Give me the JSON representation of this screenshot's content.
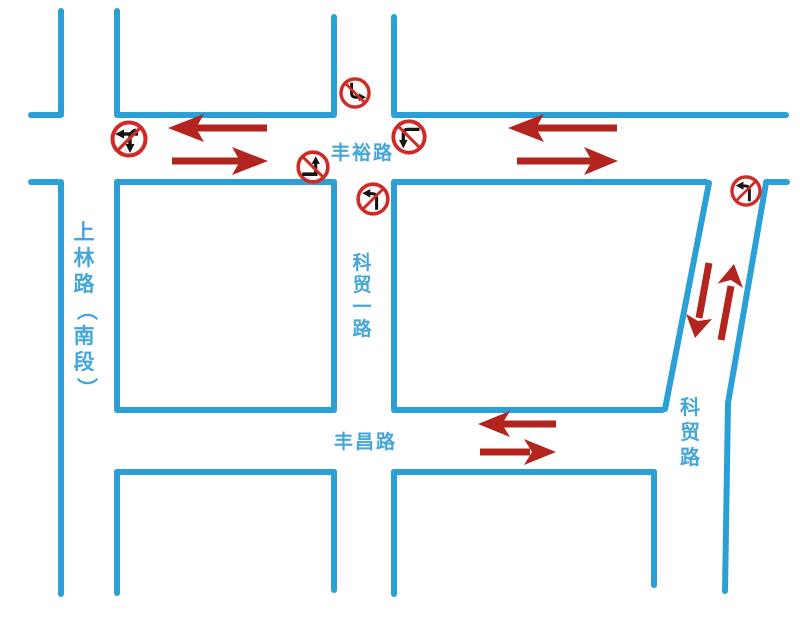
{
  "colors": {
    "road_blue": "#2aa0d6",
    "label_blue": "#45a6da",
    "flow_arrow_red": "#b4241e",
    "sign_red": "#ce2a26",
    "sign_arrow_black": "#141414"
  },
  "roads": {
    "fengyu": {
      "label": "丰裕路"
    },
    "fengchang": {
      "label": "丰昌路"
    },
    "shanglin": {
      "label": "上林路（南段）",
      "chars": [
        "上",
        "林",
        "路",
        "（",
        "南",
        "段",
        "）"
      ]
    },
    "kemao_first": {
      "label": "科贸一路",
      "chars": [
        "科",
        "贸",
        "一",
        "路"
      ]
    },
    "kemao": {
      "label": "科贸路",
      "chars": [
        "科",
        "贸",
        "路"
      ]
    }
  },
  "signs": [
    {
      "name": "no-straight-or-left-turn",
      "glyph": "left-arrow-plus-down-arrow"
    },
    {
      "name": "no-right-turn",
      "glyph": "down-then-right-arrow"
    },
    {
      "name": "no-left-turn-eastbound",
      "glyph": "right-then-up-arrow"
    },
    {
      "name": "no-left-turn-northbound",
      "glyph": "up-then-left-arrow"
    },
    {
      "name": "no-left-turn-westbound",
      "glyph": "left-then-down-arrow"
    },
    {
      "name": "no-left-turn-kemao-road",
      "glyph": "up-then-left-arrow"
    }
  ],
  "flow_arrows": [
    {
      "road": "丰裕路 west segment",
      "flow": "two-way"
    },
    {
      "road": "丰裕路 east segment",
      "flow": "two-way"
    },
    {
      "road": "丰昌路",
      "flow": "two-way"
    },
    {
      "road": "科贸路",
      "flow": "two-way"
    }
  ]
}
